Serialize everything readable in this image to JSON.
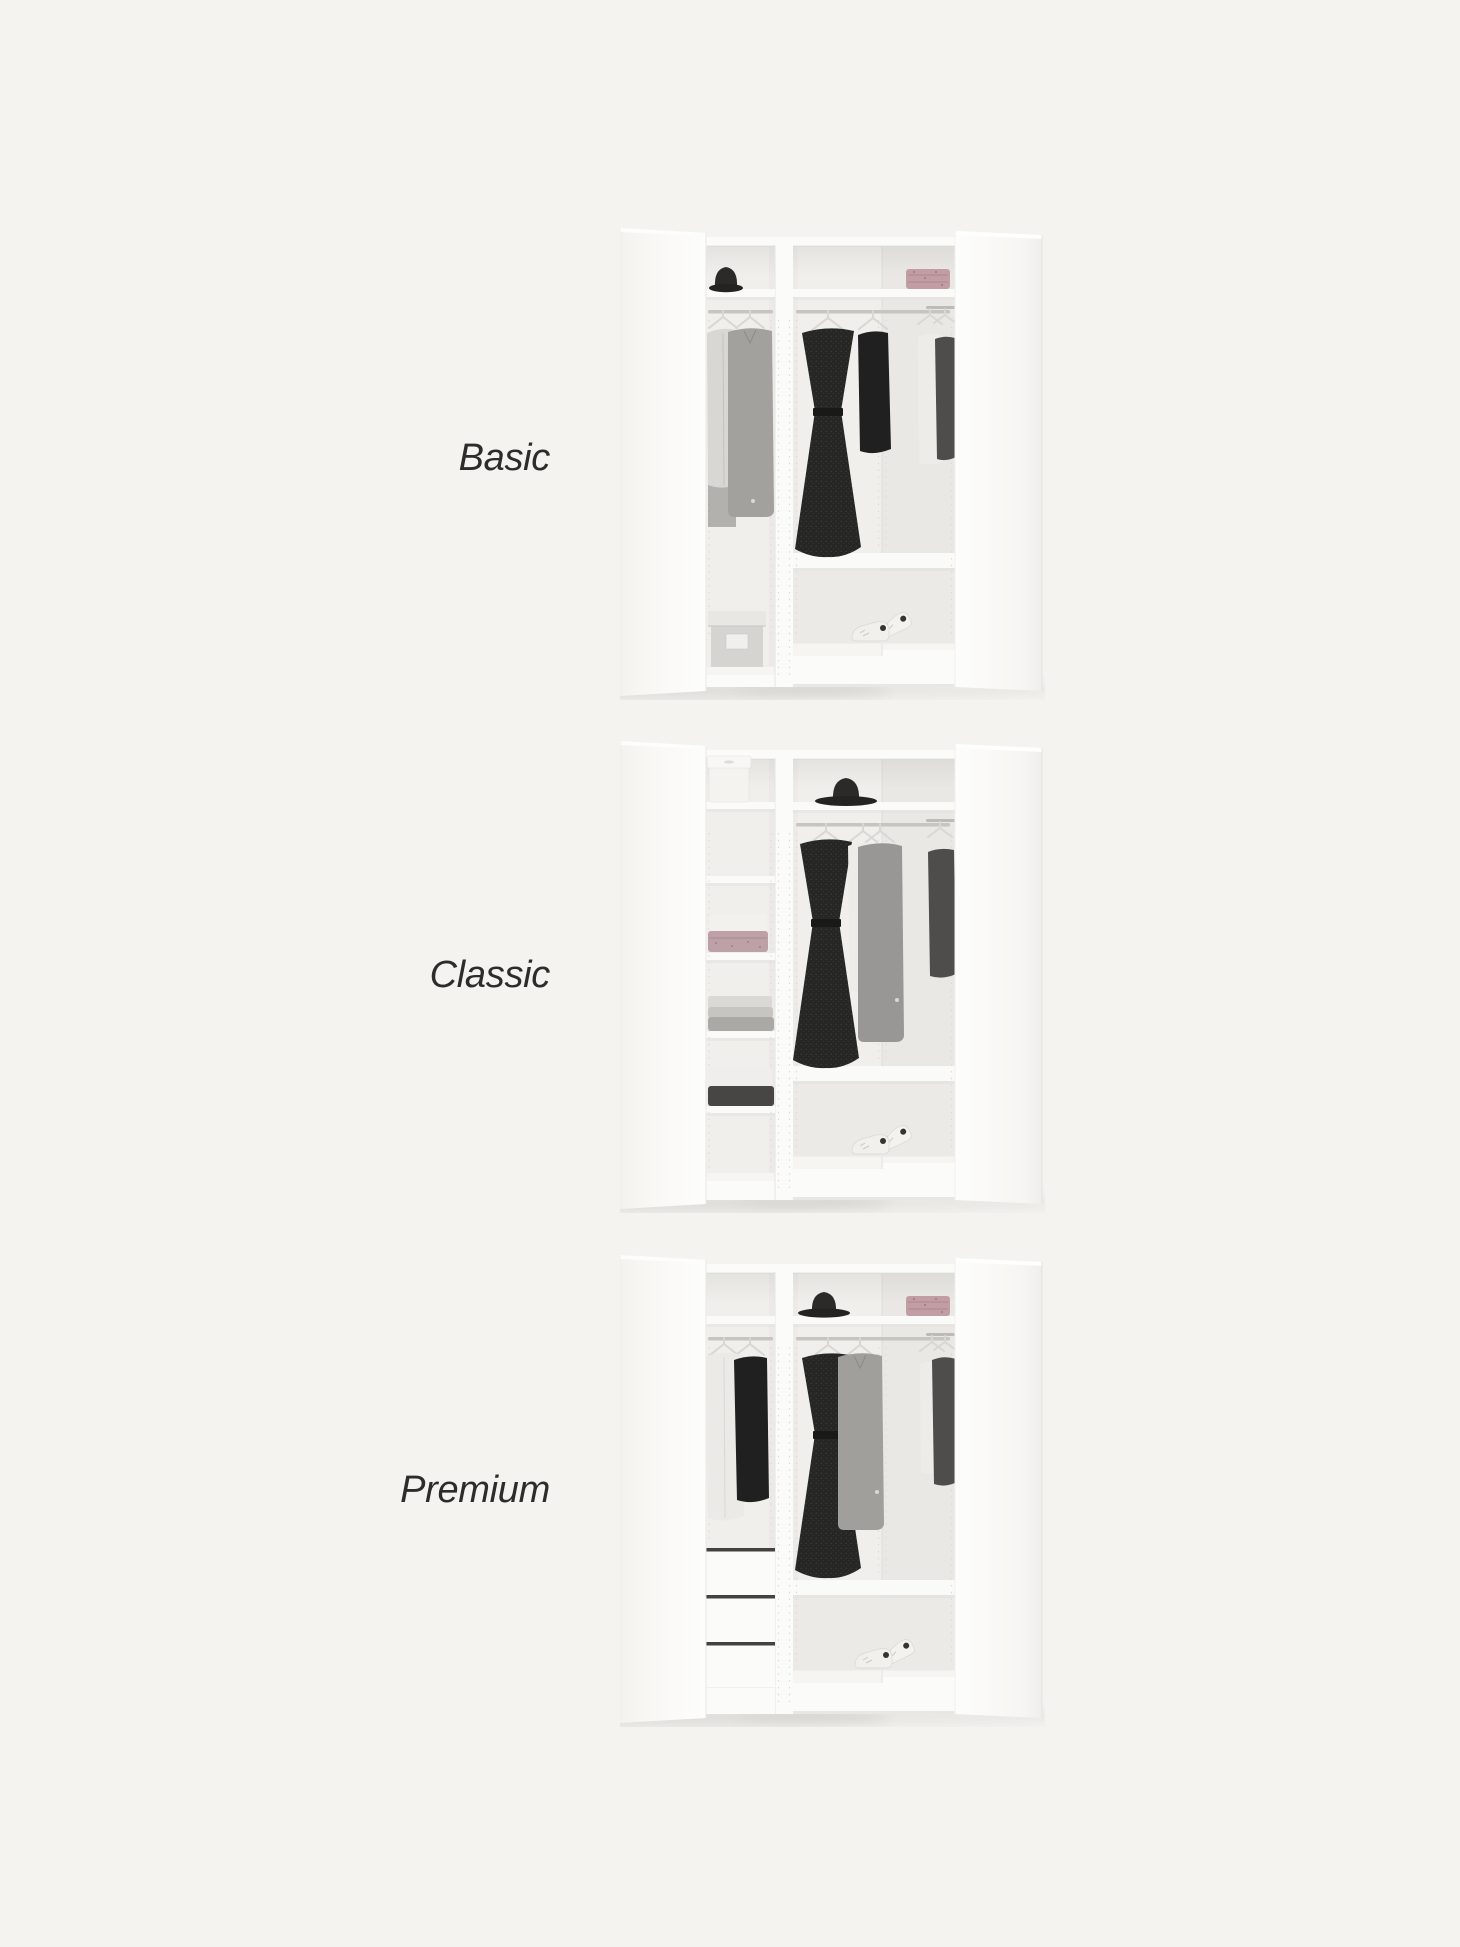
{
  "page": {
    "background_color": "#f4f3f0",
    "text_color": "#2d2c2a",
    "width": 1460,
    "height": 1947,
    "wardrobe_white": "#fbfbf9",
    "description": "Comparison of three corner wardrobe interior configurations"
  },
  "variants": [
    {
      "id": "basic",
      "label": "Basic",
      "left_section_items": [
        "black hat on top shelf",
        "light grey cardigan on hanger",
        "grey long coat on hanger",
        "grey storage box with lid on floor"
      ],
      "corner_section_items": [
        "folded pink patterned textile on top shelf",
        "black belted dress on hanger",
        "black long-sleeve top on hanger",
        "white shirt on hanger",
        "dark grey t-shirt on hanger",
        "white sneakers on floor"
      ]
    },
    {
      "id": "classic",
      "label": "Classic",
      "left_section_items": [
        "white storage bin with lid on top shelf",
        "five-shelf column",
        "folded white and pink towels",
        "folded light grey knitwear",
        "folded white and charcoal clothes"
      ],
      "corner_section_items": [
        "black hat on top shelf",
        "black belted dress on hanger",
        "light shirt on hanger",
        "grey cardigan coat on hanger",
        "dark grey t-shirt on hanger",
        "white sneakers on floor"
      ]
    },
    {
      "id": "premium",
      "label": "Premium",
      "left_section_items": [
        "white long cardigan on hanger",
        "black long-sleeve top on hanger",
        "three-drawer unit"
      ],
      "corner_section_items": [
        "black hat on top shelf",
        "folded pink patterned textile on top shelf",
        "black belted dress on hanger",
        "grey coat on hanger",
        "white long-sleeve top on hanger",
        "dark grey t-shirt on hanger",
        "white sneakers on floor"
      ]
    }
  ]
}
